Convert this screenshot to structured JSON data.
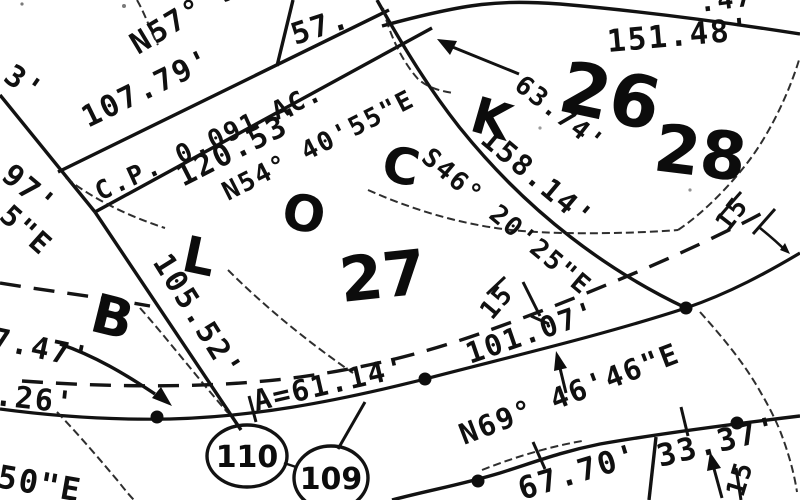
{
  "map_type": "scanned subdivision plat / survey map",
  "ink_color": "#121212",
  "paper_color": "#ffffff",
  "block": {
    "word": "BLOCK",
    "letters": [
      "B",
      "L",
      "O",
      "C",
      "K"
    ],
    "number": "27"
  },
  "lot_numbers": {
    "lot26": "26",
    "lot27": "27",
    "lot28": "28"
  },
  "parcel_circles": {
    "c110": "110",
    "c109": "109"
  },
  "labels": {
    "frag_top_left": "3'",
    "frag_97": "97'",
    "frag_5e": "5\"E",
    "frag_747": "7.47'",
    "frag_26": ".26'",
    "frag_50e": "50\"E",
    "n57": "N57° 39'",
    "d10779": "107.79'",
    "cp_area": "C.P. 0.091 AC.",
    "d12053": "120.53'",
    "n54": "N54° 40'55\"E",
    "d57": "57.",
    "d6374": "63.74'",
    "d15148": "151.48'",
    "frag_47": ".47'",
    "s46": "S46° 20'25\"E",
    "d15814": "158.14'",
    "d10552": "105.52'",
    "a61": "A=61.14'",
    "n69": "N69° 46'46\"E",
    "d10107": "101.07'",
    "w15_mid": "15",
    "w15_right": "15",
    "w15_bottom": "15",
    "d6770": "67.70'",
    "d3337": "33.37'"
  }
}
